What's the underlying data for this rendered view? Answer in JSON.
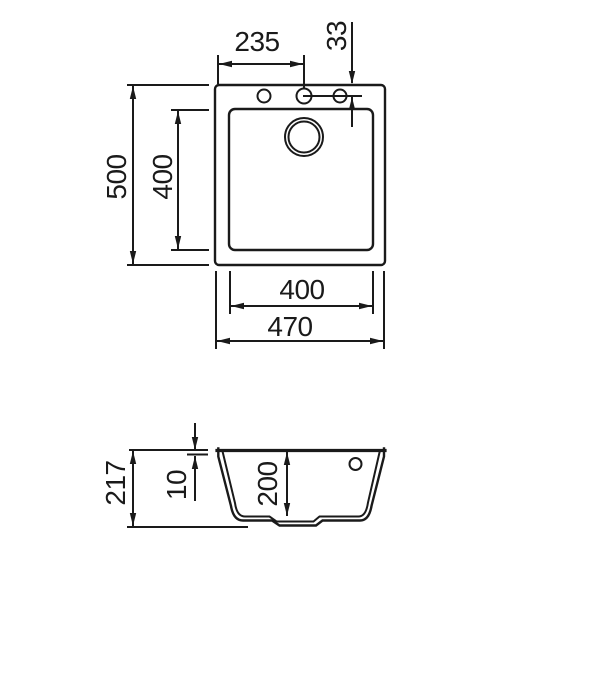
{
  "colors": {
    "line": "#1a1a1a",
    "background": "#ffffff"
  },
  "top_view": {
    "dim_faucet_center_from_left": "235",
    "dim_hole_line_from_top": "33",
    "dim_outer_depth": "500",
    "dim_bowl_depth": "400",
    "dim_bowl_width": "400",
    "dim_outer_width": "470"
  },
  "side_view": {
    "dim_total_height": "217",
    "dim_rim_thickness": "10",
    "dim_bowl_inner_depth": "200"
  }
}
